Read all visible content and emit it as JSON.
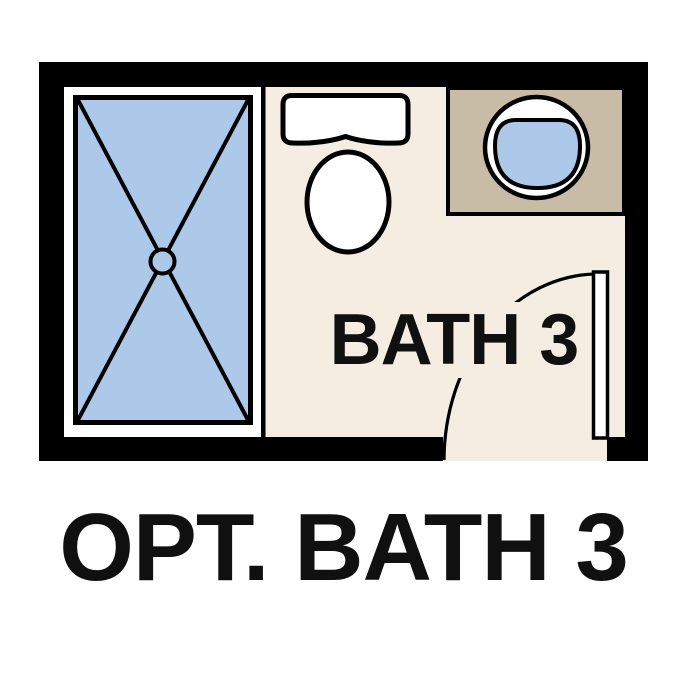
{
  "figure": {
    "room_label": "BATH 3",
    "caption": "OPT. BATH 3"
  },
  "symbols": [
    "shower-icon",
    "toilet-icon",
    "sink-vanity-icon",
    "door-swing-icon"
  ],
  "colors": {
    "walls": "#000000",
    "floor": "#F5EDE2",
    "water_blue": "#ACC9E9",
    "vanity_counter_tan": "#C8BCA6",
    "fixtures_white": "#FFFFFF",
    "text": "#101010",
    "background": "#FFFFFF"
  }
}
